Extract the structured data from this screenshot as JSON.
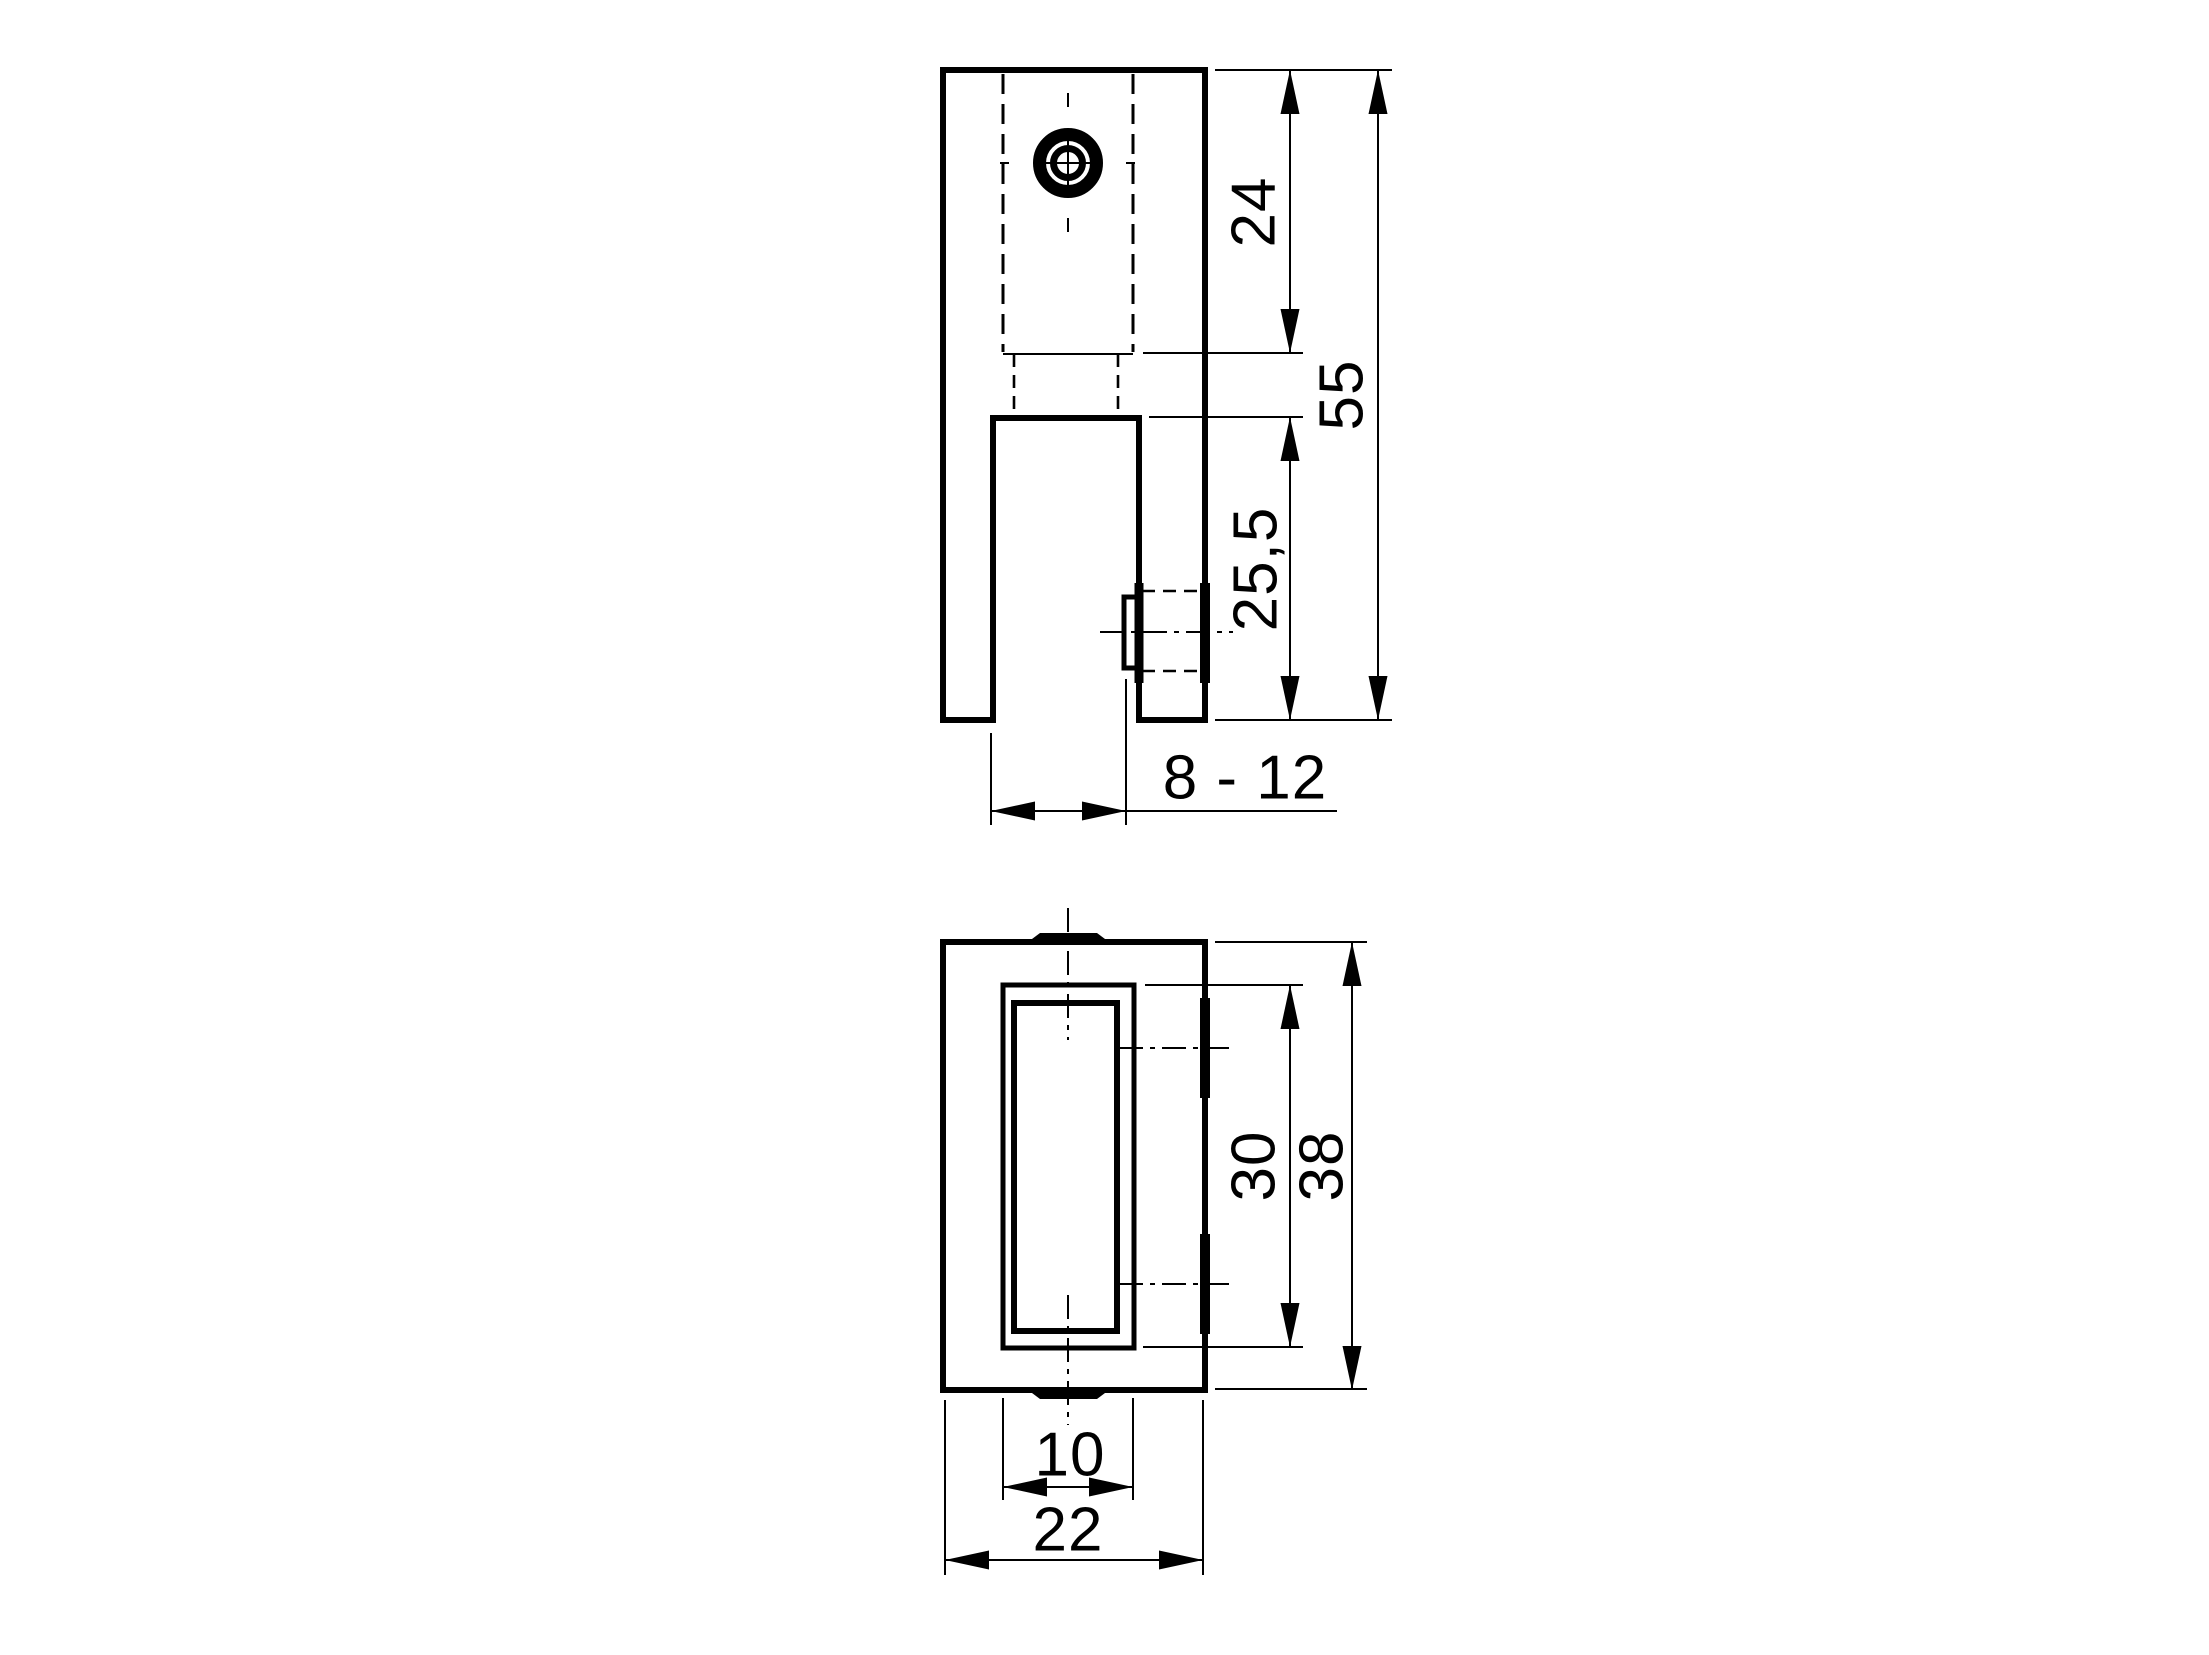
{
  "colors": {
    "background": "#ffffff",
    "line": "#000000"
  },
  "side_view": {
    "dim_counterbore_depth": "24",
    "dim_overall_height": "55",
    "dim_slot_depth": "25,5",
    "dim_clamping_range": "8 - 12"
  },
  "plan_view": {
    "dim_slot_length": "30",
    "dim_overall_length": "38",
    "dim_slot_width": "10",
    "dim_overall_width": "22"
  }
}
